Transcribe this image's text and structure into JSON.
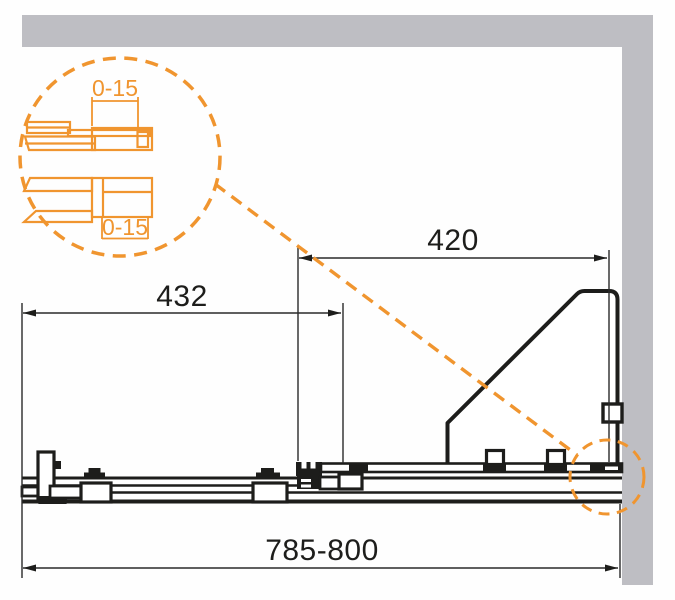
{
  "colors": {
    "accent": "#f0952f",
    "wall": "#bebec3",
    "line": "#1d1d1b",
    "background": "#ffffff"
  },
  "dimensions": {
    "overall_width": "785-800",
    "fixed_panel_width": "420",
    "sliding_door_width": "432",
    "detail_top_adjust": "0-15",
    "detail_bottom_adjust": "0-15"
  }
}
